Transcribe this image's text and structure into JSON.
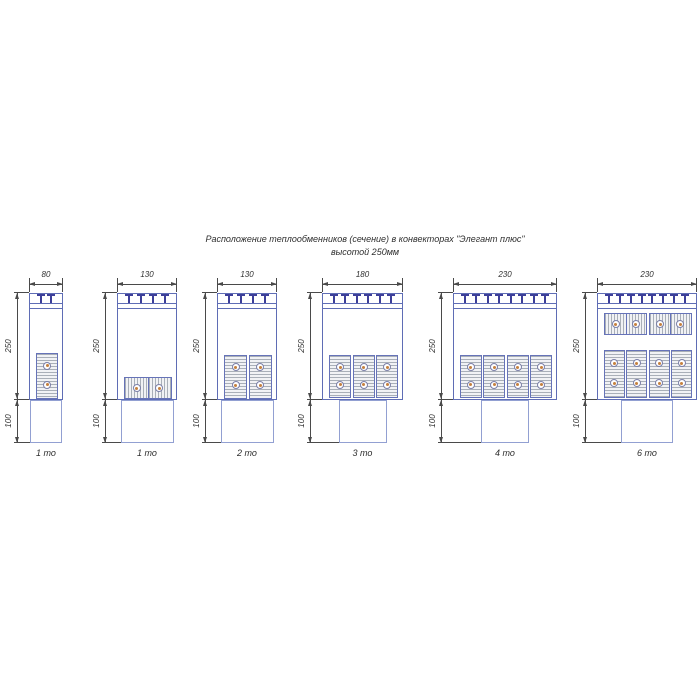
{
  "title": {
    "line1": "Расположение теплообменников (сечение) в конвекторах \"Элегант плюс\"",
    "line2": "высотой 250мм"
  },
  "dim_labels": {
    "height": "250",
    "tail": "100"
  },
  "colors": {
    "outline_blue": "#5f6db5",
    "tail_blue": "#92a0d2",
    "block_border_blue": "#6673b8",
    "clip_indigo": "#3d3f99",
    "hatch_gray": "#a9afb8",
    "block_fill": "#f1f2f5",
    "tube_orange": "#c5813f",
    "dimension_gray": "#4a4a4a",
    "text_dark": "#2e2e2e"
  },
  "diagrams": [
    {
      "width_label": "80",
      "unit_label": "1 то",
      "clips": 2,
      "rows": [
        {
          "type": "vpair",
          "count": 1,
          "tubes_per_block": 2
        }
      ],
      "layout_px": {
        "x": 29,
        "body_w": 34,
        "tail_w": 32,
        "row_boxes": [
          {
            "top": 60,
            "h": 46
          }
        ]
      }
    },
    {
      "width_label": "130",
      "unit_label": "1 то",
      "clips": 4,
      "rows": [
        {
          "type": "hpair",
          "count": 1,
          "tubes_per_block": 2
        }
      ],
      "layout_px": {
        "x": 117,
        "body_w": 60,
        "tail_w": 53,
        "row_boxes": [
          {
            "top": 84,
            "h": 22
          }
        ]
      }
    },
    {
      "width_label": "130",
      "unit_label": "2 то",
      "clips": 4,
      "rows": [
        {
          "type": "vpair",
          "count": 2,
          "tubes_per_block": 2
        }
      ],
      "layout_px": {
        "x": 217,
        "body_w": 60,
        "tail_w": 53,
        "row_boxes": [
          {
            "top": 62,
            "h": 44
          }
        ]
      }
    },
    {
      "width_label": "180",
      "unit_label": "3 то",
      "clips": 6,
      "rows": [
        {
          "type": "vpair",
          "count": 3,
          "tubes_per_block": 2
        }
      ],
      "layout_px": {
        "x": 322,
        "body_w": 81,
        "tail_w": 48,
        "row_boxes": [
          {
            "top": 62,
            "h": 43
          }
        ]
      }
    },
    {
      "width_label": "230",
      "unit_label": "4 то",
      "clips": 8,
      "rows": [
        {
          "type": "vpair",
          "count": 4,
          "tubes_per_block": 2
        }
      ],
      "layout_px": {
        "x": 453,
        "body_w": 104,
        "tail_w": 48,
        "row_boxes": [
          {
            "top": 62,
            "h": 43
          }
        ]
      }
    },
    {
      "width_label": "230",
      "unit_label": "6 то",
      "clips": 8,
      "rows": [
        {
          "type": "hpair",
          "count": 2,
          "tubes_per_block": 2
        },
        {
          "type": "vpair",
          "count": 4,
          "tubes_per_block": 2
        }
      ],
      "layout_px": {
        "x": 597,
        "body_w": 100,
        "tail_w": 52,
        "row_boxes": [
          {
            "top": 20,
            "h": 22
          },
          {
            "top": 57,
            "h": 48
          }
        ]
      }
    }
  ]
}
